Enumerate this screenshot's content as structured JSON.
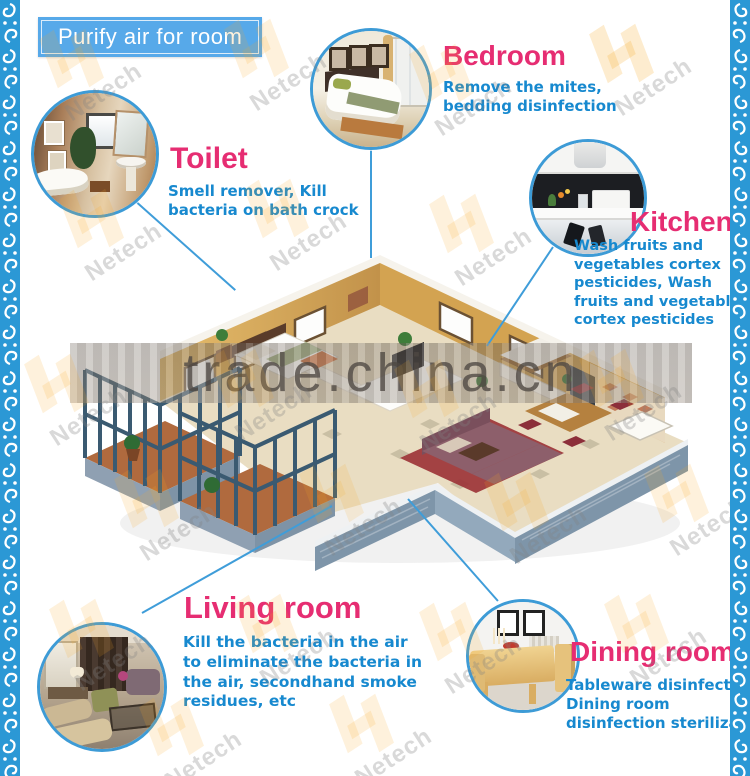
{
  "header": {
    "label": "Purify air for room"
  },
  "watermark": {
    "brand": "Netech",
    "site": "trade.china.cn"
  },
  "rooms": {
    "bedroom": {
      "title": "Bedroom",
      "description": "Remove the mites,\nbedding disinfection",
      "photo_alt": "hotel bedroom with white bed"
    },
    "toilet": {
      "title": "Toilet",
      "description": "Smell remover, Kill\nbacteria on bath crock",
      "photo_alt": "bathroom with bathtub mirror and sink"
    },
    "kitchen": {
      "title": "Kitchen",
      "description": "Wash fruits and\nvegetables cortex\npesticides, Wash\nfruits and vegetables\ncortex pesticides",
      "photo_alt": "modern kitchen with range hood"
    },
    "living": {
      "title": "Living room",
      "description": "Kill the bacteria in the air\nto eliminate the bacteria in\nthe air, secondhand smoke\nresidues, etc",
      "photo_alt": "living room with sofas and curtains"
    },
    "dining": {
      "title": "Dining room",
      "description": "Tableware disinfection.\nDining room\ndisinfection sterilization",
      "photo_alt": "wooden dining table and chairs"
    }
  },
  "colors": {
    "title_pink": "#e62d72",
    "description_blue": "#1789cf",
    "line_blue": "#3f9dd9",
    "header_blue": "#57a9e9",
    "border_blue": "#2b98d5"
  }
}
